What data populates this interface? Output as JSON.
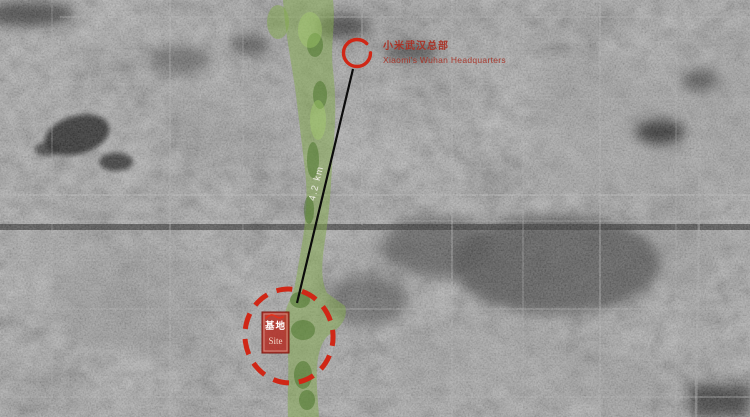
{
  "annotations": {
    "headquarters": {
      "label_zh": "小米武汉总部",
      "label_en": "Xiaomi's Wuhan Headquarters"
    },
    "distance": {
      "label": "4.2 km"
    },
    "site": {
      "label_zh": "基地",
      "label_en": "Site"
    }
  },
  "colors": {
    "marker_red": "#d02716",
    "label_red": "#a93428",
    "corridor_green": "#84ab4e",
    "site_fill": "#b42a20",
    "distance_text": "#edece4"
  }
}
